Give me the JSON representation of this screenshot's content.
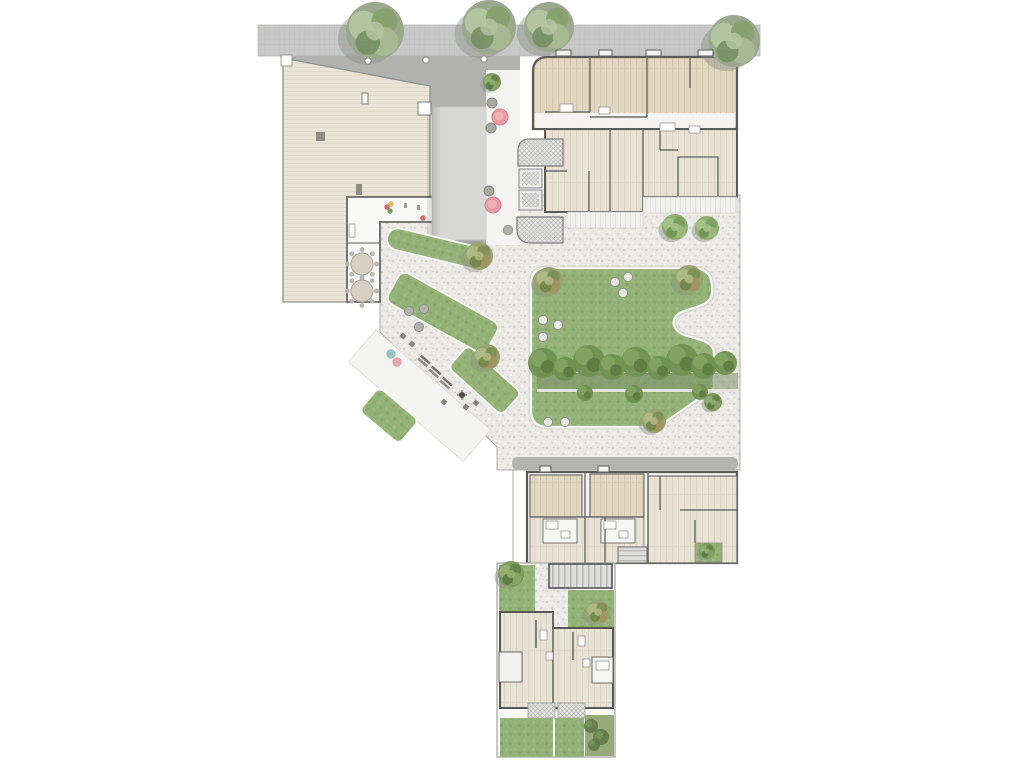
{
  "meta": {
    "title": "Residential courtyard masterplan",
    "kind": "architectural-site-plan",
    "description": "Top-down rendered site plan: street with trees at top, large roof building left, canopy passage, apartment blocks with timber floors, central lawn courtyard with hedge walk, gym terrace, and two lower housing blocks with private gardens"
  },
  "palette": {
    "road": "#c8c8c8",
    "walkway_dark": "#b1b1af",
    "roof_beige": "#ebe5d8",
    "wood_dark": "#e0d6c1",
    "wood_pale": "#e8e2d4",
    "canopy": "#d7d7d5",
    "pebble": "#ebe9e5",
    "lawn": "#93b277",
    "hedge_dark": "#6f9150",
    "wall": "#5a5a57",
    "boundary": "#a2a29f",
    "pink_planter": "#e79ca4",
    "teal_dot": "#8fc6bd",
    "red_dot": "#d9686a",
    "white_paving": "#f4f4f2"
  },
  "features": {
    "street_trees": [
      {
        "x": 375,
        "y": 31,
        "r": 29,
        "k": "street"
      },
      {
        "x": 489,
        "y": 27,
        "r": 27,
        "k": "street"
      },
      {
        "x": 549,
        "y": 27,
        "r": 25,
        "k": "street"
      },
      {
        "x": 734,
        "y": 41,
        "r": 26,
        "k": "street"
      }
    ],
    "bollards": [
      [
        368,
        61
      ],
      [
        426,
        60
      ],
      [
        484,
        59
      ]
    ],
    "planters": [
      {
        "x": 492,
        "y": 82,
        "r": 9,
        "k": "shrub"
      },
      {
        "x": 492,
        "y": 103,
        "r": 5,
        "k": "stone"
      },
      {
        "x": 500,
        "y": 117,
        "r": 8,
        "k": "pink"
      },
      {
        "x": 491,
        "y": 128,
        "r": 5,
        "k": "stone"
      },
      {
        "x": 489,
        "y": 191,
        "r": 5,
        "k": "stone"
      },
      {
        "x": 493,
        "y": 205,
        "r": 8,
        "k": "pink"
      }
    ],
    "courtyard_trees": [
      {
        "x": 479,
        "y": 256,
        "r": 14,
        "k": "olive"
      },
      {
        "x": 487,
        "y": 357,
        "r": 13,
        "k": "olive"
      },
      {
        "x": 675,
        "y": 227,
        "r": 13,
        "k": "green"
      },
      {
        "x": 707,
        "y": 228,
        "r": 12,
        "k": "green"
      }
    ],
    "lawn_trees": [
      {
        "x": 549,
        "y": 281,
        "r": 14,
        "k": "olive"
      },
      {
        "x": 689,
        "y": 279,
        "r": 14,
        "k": "olive"
      },
      {
        "x": 654,
        "y": 421,
        "r": 12,
        "k": "olive"
      },
      {
        "x": 713,
        "y": 402,
        "r": 9,
        "k": "dark"
      }
    ],
    "garden_trees": [
      {
        "x": 511,
        "y": 574,
        "r": 13,
        "k": "dark"
      },
      {
        "x": 598,
        "y": 612,
        "r": 12,
        "k": "olive"
      },
      {
        "x": 707,
        "y": 551,
        "r": 8,
        "k": "dark"
      }
    ],
    "stepping_stones": [
      [
        615,
        282,
        0
      ],
      [
        628,
        277,
        0
      ],
      [
        623,
        293,
        0
      ],
      [
        543,
        320,
        0
      ],
      [
        558,
        325,
        0
      ],
      [
        543,
        337,
        0
      ],
      [
        548,
        422,
        0
      ],
      [
        565,
        422,
        0
      ],
      [
        409,
        311,
        1
      ],
      [
        424,
        309,
        1
      ],
      [
        419,
        327,
        1
      ],
      [
        508,
        230,
        1
      ]
    ],
    "hedge_shadow": {
      "x": 537,
      "y": 372,
      "w": 201,
      "h": 18
    },
    "hedge_path_lines": [
      {
        "x": 537,
        "y": 370,
        "w": 201,
        "h": 3
      },
      {
        "x": 537,
        "y": 389,
        "w": 201,
        "h": 3
      }
    ],
    "hedge_blobs": [
      [
        543,
        363,
        15
      ],
      [
        565,
        369,
        12
      ],
      [
        589,
        361,
        16
      ],
      [
        612,
        367,
        13
      ],
      [
        636,
        362,
        15
      ],
      [
        659,
        368,
        12
      ],
      [
        682,
        360,
        16
      ],
      [
        704,
        366,
        13
      ],
      [
        725,
        363,
        12
      ],
      [
        585,
        393,
        8
      ],
      [
        634,
        394,
        9
      ],
      [
        700,
        392,
        8
      ]
    ],
    "garden_shrub_blobs": [
      [
        591,
        726,
        7
      ],
      [
        601,
        737,
        8
      ],
      [
        594,
        745,
        6
      ]
    ],
    "tables": [
      [
        362,
        264
      ],
      [
        362,
        291
      ]
    ],
    "gym_benches": [
      [
        424,
        361
      ],
      [
        435,
        372
      ],
      [
        446,
        383
      ]
    ],
    "small_planter_boxes": [
      [
        403,
        336
      ],
      [
        412,
        344
      ],
      [
        444,
        402
      ],
      [
        476,
        403
      ],
      [
        466,
        407
      ]
    ],
    "lamp_post": [
      462,
      395
    ],
    "color_dots": [
      {
        "x": 391,
        "y": 354,
        "c": "teal"
      },
      {
        "x": 397,
        "y": 362,
        "c": "pink"
      },
      {
        "x": 423,
        "y": 218,
        "c": "red"
      },
      {
        "x": 387,
        "y": 207,
        "c": "red"
      },
      {
        "x": 391,
        "y": 204,
        "c": "yellow"
      },
      {
        "x": 390,
        "y": 211,
        "c": "green"
      }
    ],
    "gray_marks": [
      [
        404,
        203
      ],
      [
        417,
        205
      ]
    ],
    "appliances": [
      [
        560,
        104,
        13,
        8
      ],
      [
        599,
        107,
        11,
        7
      ],
      [
        660,
        123,
        15,
        8
      ],
      [
        689,
        126,
        11,
        7
      ],
      [
        546,
        521,
        12,
        8
      ],
      [
        561,
        531,
        9,
        7
      ],
      [
        604,
        521,
        12,
        8
      ],
      [
        619,
        531,
        9,
        7
      ],
      [
        540,
        630,
        7,
        10
      ],
      [
        578,
        636,
        7,
        10
      ],
      [
        546,
        652,
        7,
        8
      ],
      [
        583,
        659,
        7,
        8
      ],
      [
        349,
        224,
        6,
        13
      ],
      [
        596,
        661,
        13,
        9
      ]
    ],
    "roof_vents": [
      [
        556,
        50,
        15,
        6
      ],
      [
        599,
        50,
        13,
        6
      ],
      [
        646,
        50,
        15,
        6
      ],
      [
        698,
        50,
        15,
        6
      ],
      [
        540,
        466,
        11,
        6
      ],
      [
        598,
        466,
        11,
        6
      ]
    ],
    "roof_markers": [
      {
        "x": 418,
        "y": 102,
        "w": 13,
        "h": 13,
        "f": "#fdfdfc",
        "s": "#7a7a76"
      },
      {
        "x": 362,
        "y": 93,
        "w": 6,
        "h": 11,
        "f": "#fdfdfc",
        "s": "#7a7a76"
      },
      {
        "x": 281,
        "y": 55,
        "w": 11,
        "h": 11,
        "f": "#fbfbfa",
        "s": "#9a9a97"
      },
      {
        "x": 316,
        "y": 132,
        "w": 9,
        "h": 9,
        "f": "#8e8e8a",
        "s": "none"
      },
      {
        "x": 356,
        "y": 184,
        "w": 6,
        "h": 11,
        "f": "#8e8e8a",
        "s": "none"
      }
    ]
  }
}
